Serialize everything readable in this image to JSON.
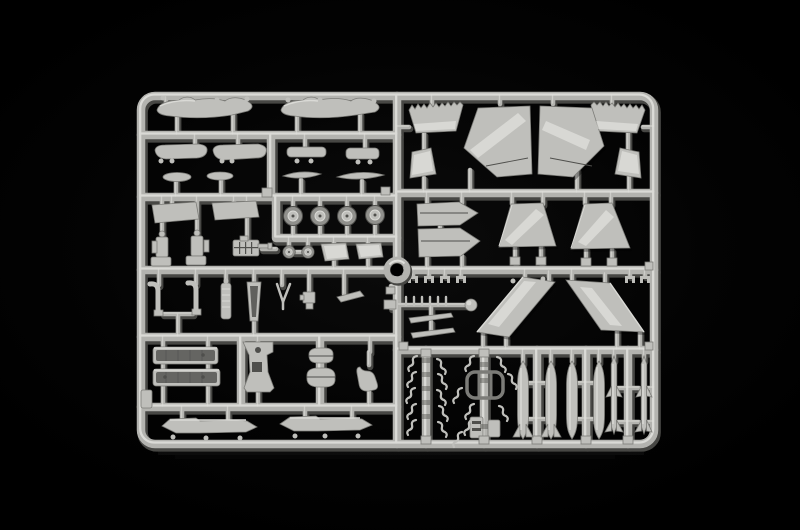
{
  "scene": {
    "type": "photograph",
    "description": "Light grey injection-moulded plastic model kit sprue (parts frame) for a jet aircraft kit, photographed on a black background",
    "background": "black",
    "sprue_material": "light grey polystyrene"
  },
  "colors": {
    "background": "#000000",
    "rail_shadow": "#474744",
    "rail_main": "#b3b3af",
    "rail_highlight": "#dfdfdb",
    "plastic_base": "#bfbfbb",
    "plastic_light": "#dadad6",
    "plastic_dark": "#90908c",
    "plastic_deep": "#4f4f4c",
    "part_edge": "#7c7c78",
    "glint": "#f1f1ed"
  },
  "parts_legend": {
    "top_left": "drop tank and store halves",
    "mid_left": "access panels, ejection seats, landing gear wheels, gun unit",
    "mid_band": "landing gear legs, struts, nose cone, antennas",
    "lower_left": "cockpit tubs, keel part, underwing pylons",
    "top_right": "vertical stabilizers with serrated fins and rudders",
    "mid_right": "intake ramps and ventral fins",
    "wings": "upper and lower main wing halves",
    "bottom_right": "missiles, drop tanks and runners of small detail parts",
    "center": "circular locating ring"
  }
}
